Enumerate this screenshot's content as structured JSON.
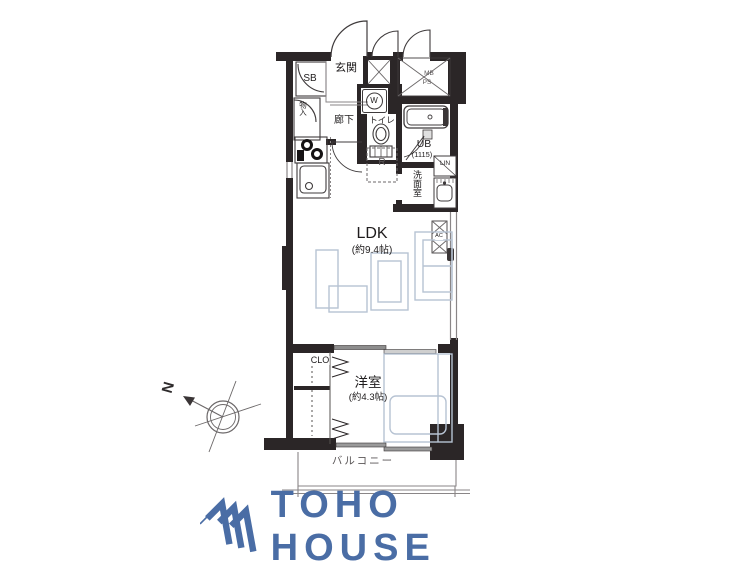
{
  "plan": {
    "labels": {
      "genkan": "玄関",
      "sb": "SB",
      "monoire": "物入",
      "rouka": "廊下",
      "toilet": "トイレ",
      "ub": "UB",
      "ub_size": "(1115)",
      "senmenshitsu": "洗面室",
      "lin": "LIN",
      "refrigerator": "R",
      "washer": "W",
      "mb": "MB",
      "ps": "PS",
      "ac": "AC",
      "ldk": "LDK",
      "ldk_size": "(約9.4帖)",
      "clo": "CLO",
      "yoshitsu": "洋室",
      "yoshitsu_size": "(約4.3帖)",
      "balcony": "バルコニー"
    },
    "compass": {
      "north": "N"
    },
    "colors": {
      "wall": "#2b2627",
      "line": "#3f3b3c",
      "furniture": "#b7c3d3",
      "logo_blue": "#4a6da5"
    }
  },
  "logo": {
    "text": "TOHO HOUSE"
  }
}
